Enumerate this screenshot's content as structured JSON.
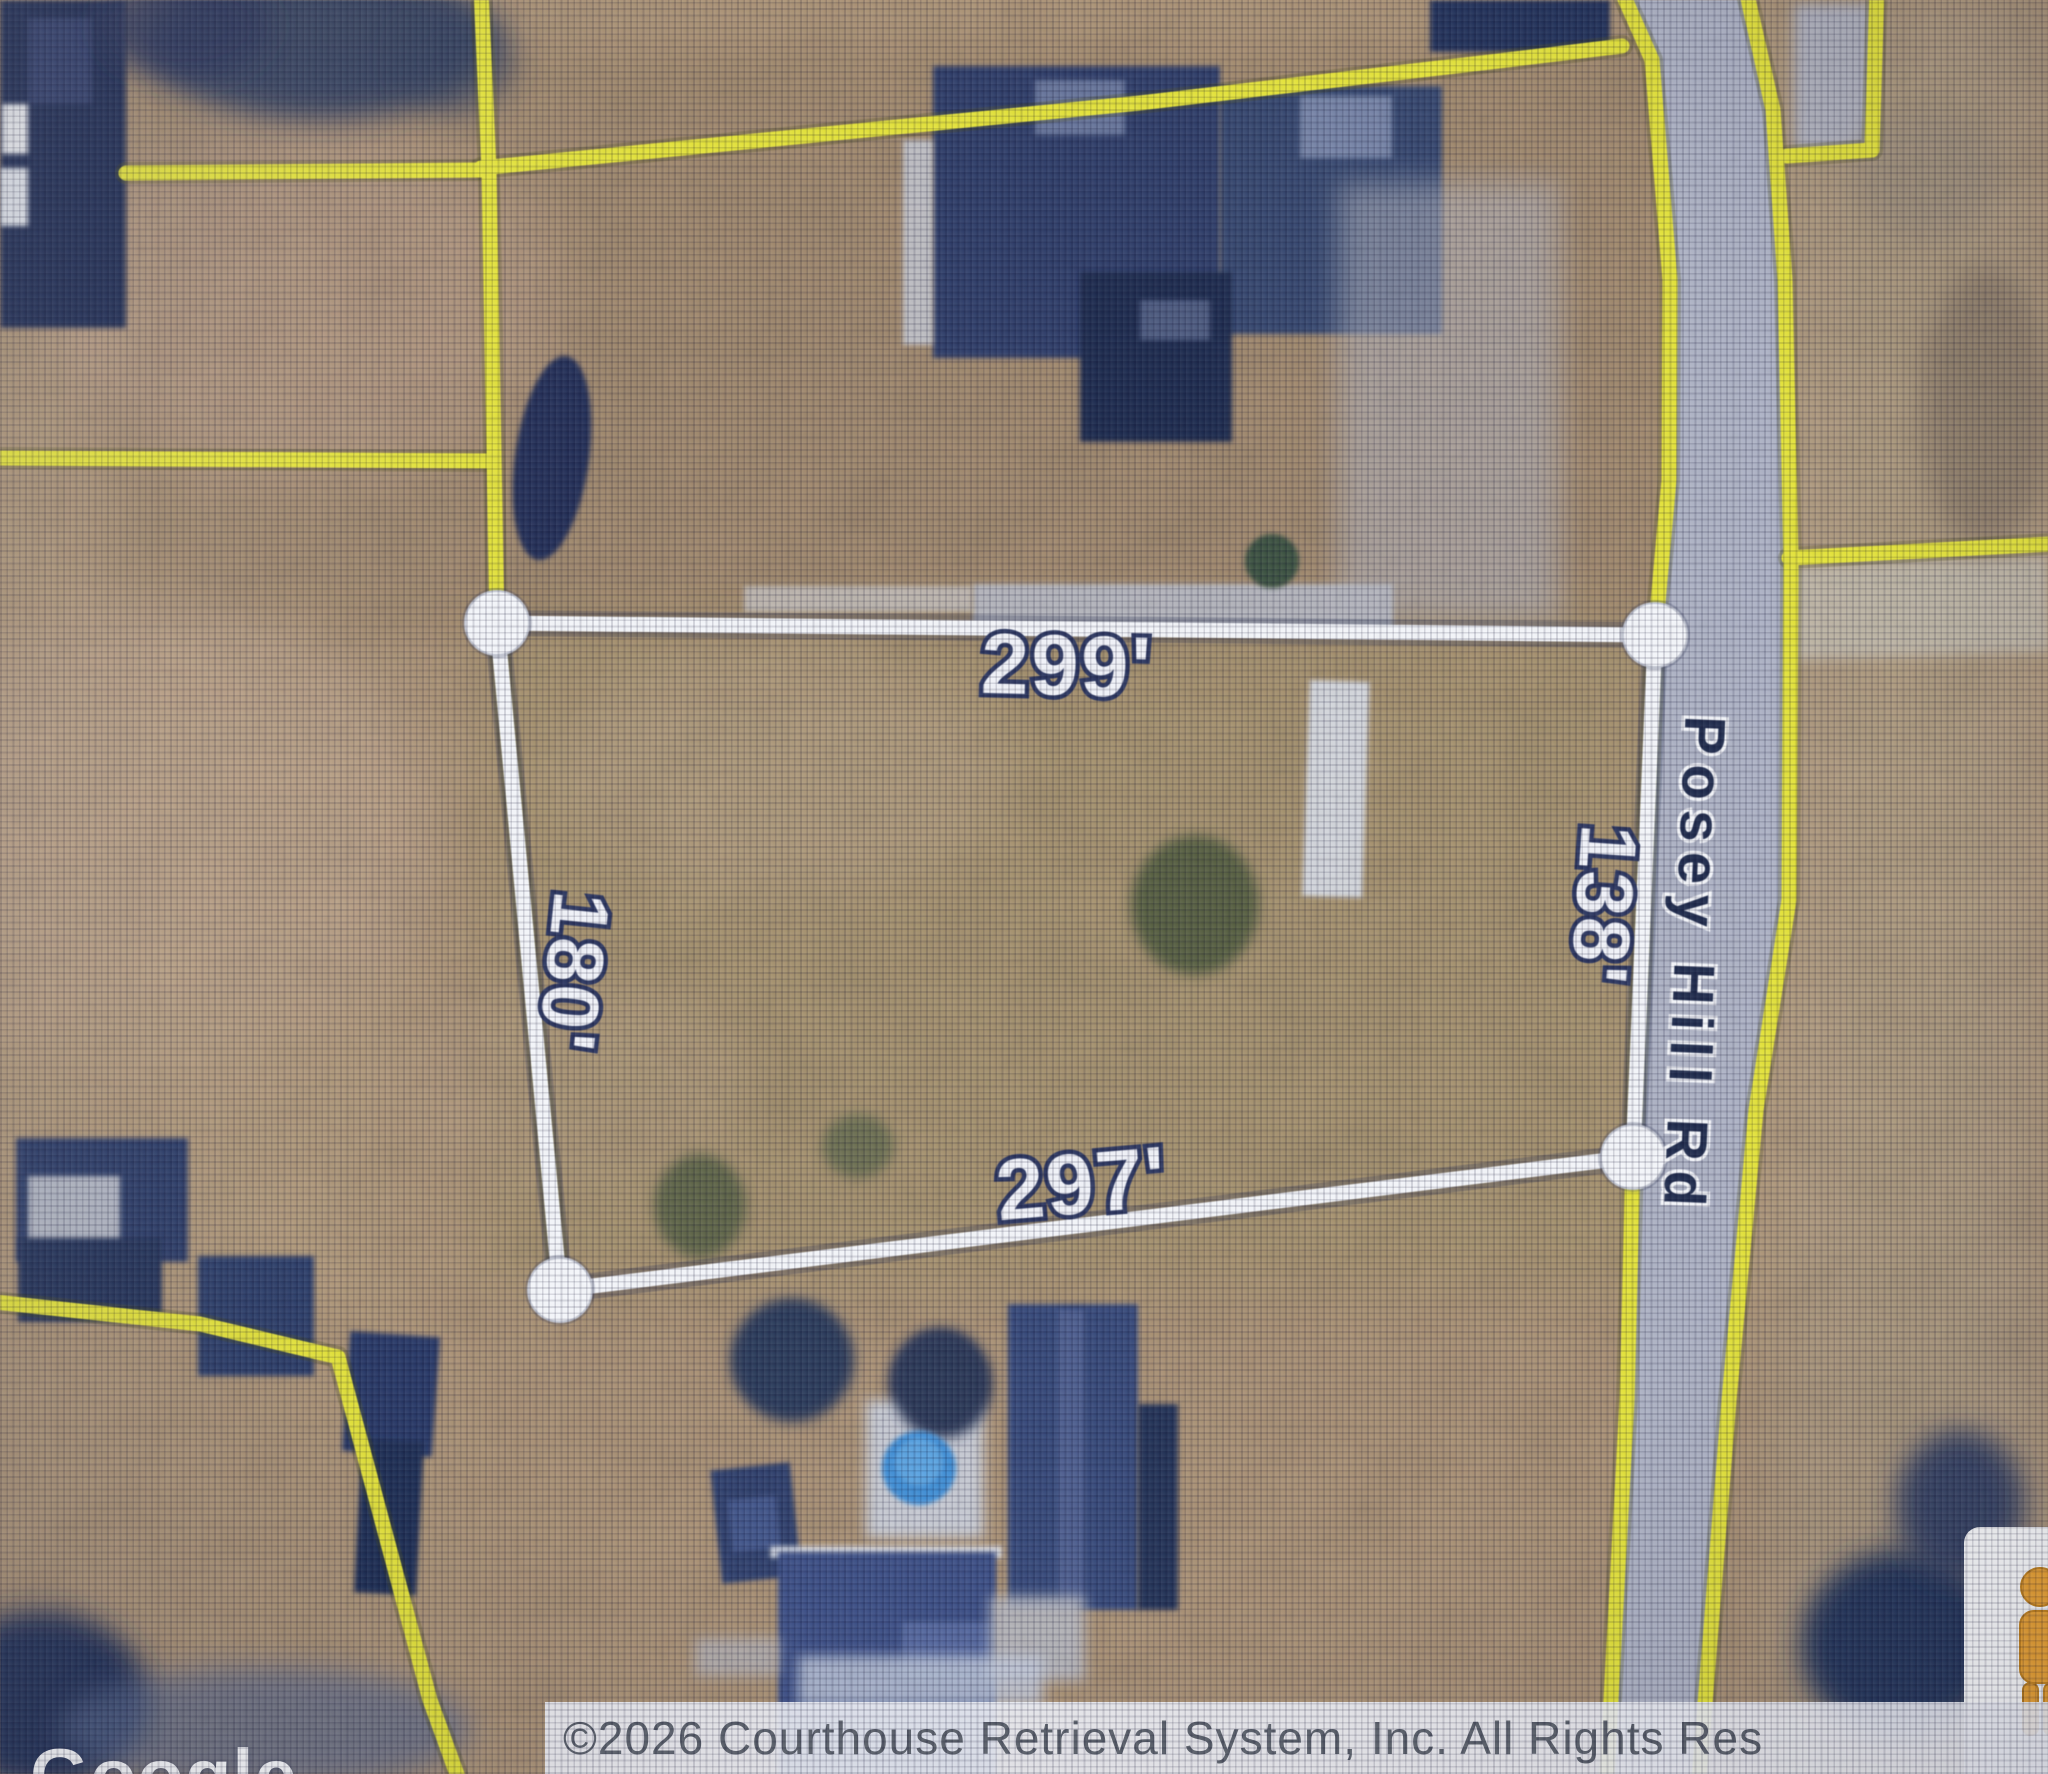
{
  "map": {
    "road_label": "Posey Hill Rd",
    "parcel": {
      "dim_top": "299'",
      "dim_left": "180'",
      "dim_bottom": "297'",
      "dim_right": "138'"
    },
    "attribution": "©2026 Courthouse Retrieval System, Inc. All Rights Res",
    "watermark": "Google",
    "colors": {
      "boundary_yellow": "#e4e333",
      "selection_white": "#f5f7fb",
      "road_surface": "#aeb4ca",
      "road_label_navy": "#1e2a4d",
      "dimension_outline_navy": "#2a3560",
      "roof_navy": "#2d3d6b",
      "pool_blue": "#3e8ed8",
      "pegman_orange": "#e9a02f"
    }
  }
}
